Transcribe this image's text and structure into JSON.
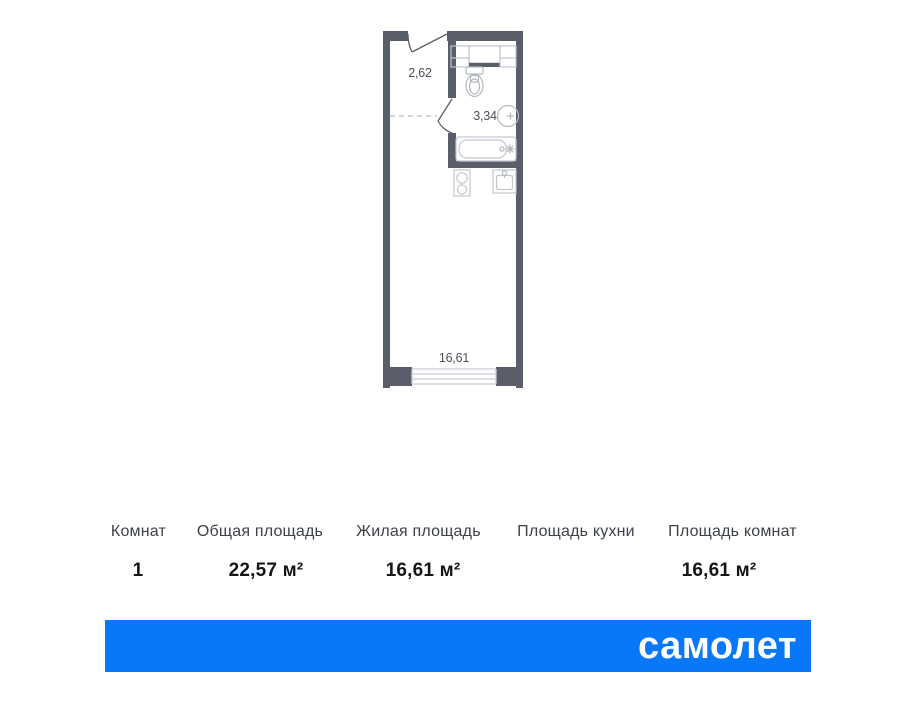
{
  "floorplan": {
    "labels": {
      "hallway": "2,62",
      "bathroom": "3,34",
      "living_room": "16,61"
    }
  },
  "table": {
    "columns": [
      {
        "header": "Комнат",
        "value": "1"
      },
      {
        "header": "Общая площадь",
        "value": "22,57 м²"
      },
      {
        "header": "Жилая площадь",
        "value": "16,61 м²"
      },
      {
        "header": "Площадь кухни",
        "value": ""
      },
      {
        "header": "Площадь комнат",
        "value": "16,61 м²"
      }
    ]
  },
  "footer": {
    "brand": "самолет"
  },
  "colors": {
    "wall": "#5A5E6A",
    "fixture_line": "#C2C6CE",
    "dimension_text": "#4B505A",
    "header_text": "#3D4148",
    "value_text": "#15161A",
    "banner_blue": "#0878F8"
  }
}
